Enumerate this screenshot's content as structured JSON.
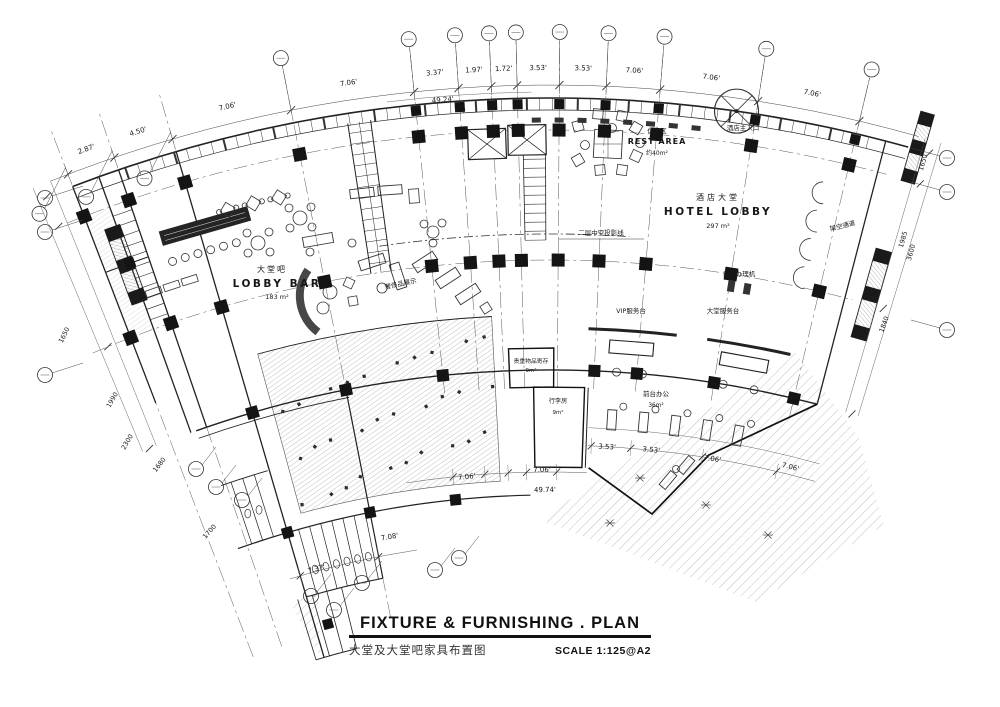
{
  "drawing": {
    "ink": "#1b1b1b",
    "rooms": [
      {
        "cn": "休息区",
        "en": "REST AREA",
        "area": "约40m²"
      },
      {
        "cn": "酒店大堂",
        "en": "HOTEL LOBBY",
        "area": "297 m²"
      },
      {
        "cn": "大堂吧",
        "en": "LOBBY BAR",
        "area": "183 m²"
      }
    ],
    "annotations": [
      "酒店主入口",
      "二层中空投影线",
      "自助办理机",
      "VIP服务台",
      "大堂服务台",
      "架空通道",
      "奢侈品展示"
    ],
    "small_rooms": [
      {
        "name": "贵重物品寄存",
        "area": "9m²"
      },
      {
        "name": "行李房",
        "area": "9m²"
      },
      {
        "name": "前台办公",
        "area": "36m²"
      }
    ],
    "dims_top": [
      "2.87'",
      "4.50'",
      "7.06'",
      "7.06'",
      "3.37'",
      "1.97'",
      "1.72'",
      "3.53'",
      "3.53'",
      "7.06'",
      "7.06'",
      "7.06'"
    ],
    "dim_overall_top": "49.24'",
    "dims_bottom": [
      "7.37'",
      "7.08'",
      "7.06'",
      "7.06'",
      "3.53'",
      "3.53'",
      "7.06'",
      "7.06'"
    ],
    "dim_overall_bottom": "49.74'",
    "dims_left": [
      "1650",
      "1990",
      "2300",
      "1680",
      "1700"
    ],
    "dims_right": [
      "1650",
      "1985",
      "3600",
      "1840"
    ]
  },
  "title_block": {
    "title": "FIXTURE & FURNISHING . PLAN",
    "subtitle_cn": "大堂及大堂吧家具布置图",
    "scale_label": "SCALE  1:125@A2"
  }
}
